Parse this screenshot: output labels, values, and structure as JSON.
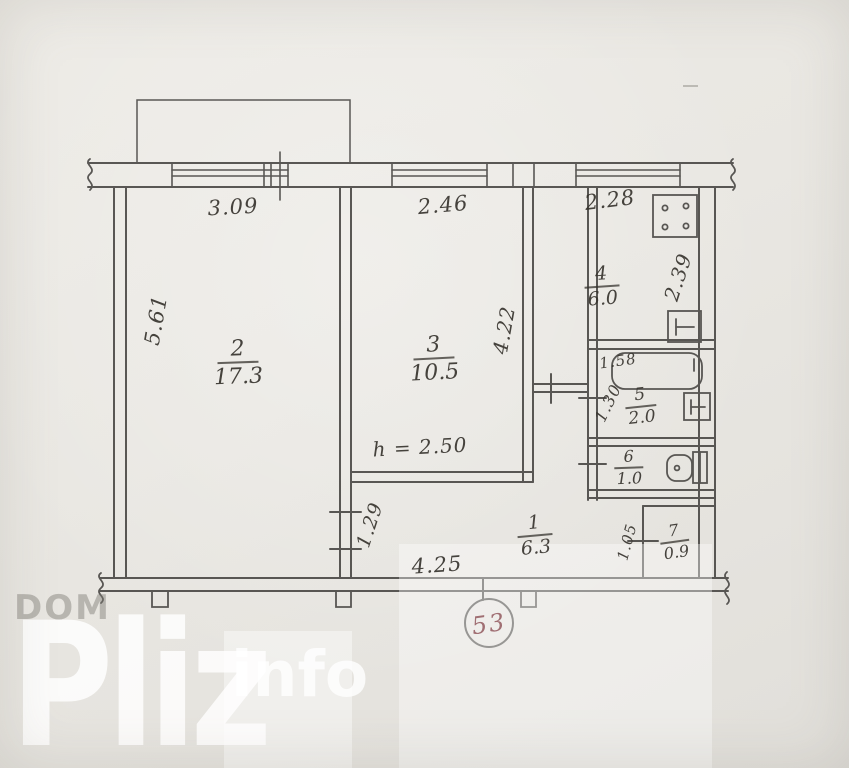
{
  "plan": {
    "apartment_number": "53",
    "ceiling_height": "h = 2.50",
    "rooms": {
      "r1": {
        "num": "1",
        "area": "6.3"
      },
      "r2": {
        "num": "2",
        "area": "17.3"
      },
      "r3": {
        "num": "3",
        "area": "10.5"
      },
      "r4": {
        "num": "4",
        "area": "6.0"
      },
      "r5": {
        "num": "5",
        "area": "2.0"
      },
      "r6": {
        "num": "6",
        "area": "1.0"
      },
      "r7": {
        "num": "7",
        "area": "0.9"
      }
    },
    "dims": {
      "top_left": "3.09",
      "top_mid": "2.46",
      "top_right": "2.28",
      "left_side": "5.61",
      "room3_right": "4.22",
      "kitchen_depth": "2.39",
      "bathtub_length": "1.58",
      "bath_width": "1.30",
      "hall_west": "1.29",
      "hall_bottom": "4.25",
      "pantry_width": "1.05"
    },
    "icons": {
      "stove": "stove-icon",
      "kitchen_sink": "sink-icon",
      "bathtub": "bathtub-icon",
      "bath_sink": "sink-icon",
      "toilet": "toilet-icon"
    },
    "colors": {
      "ink": "#454340",
      "paper": "#e9e7e2",
      "badge_ink": "#97656a",
      "watermark_gray": "#b1aea9"
    }
  },
  "watermark": {
    "dom": "DOM",
    "pliz": "Pliz",
    "info": "info"
  }
}
